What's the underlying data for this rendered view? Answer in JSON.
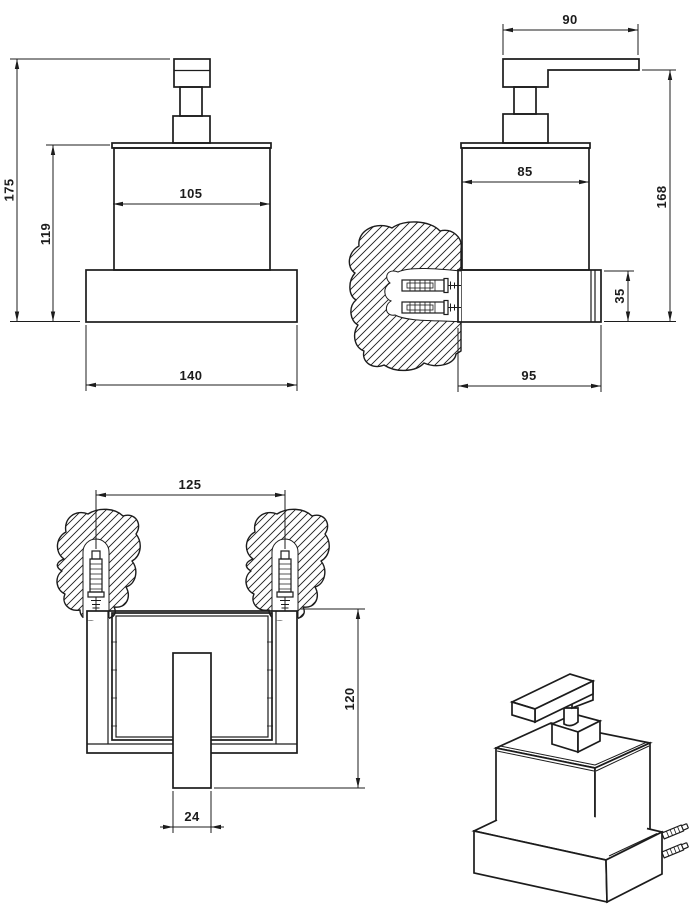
{
  "drawing": {
    "front_view": {
      "overall_height": "175",
      "body_height": "119",
      "body_width": "105",
      "base_width": "140"
    },
    "side_view": {
      "lever_length": "90",
      "body_depth": "85",
      "overall_height": "168",
      "holder_height": "35",
      "holder_depth": "95"
    },
    "top_view": {
      "fixing_spacing": "125",
      "overall_depth": "120",
      "spout_width": "24"
    }
  },
  "colors": {
    "line": "#1c1c1c",
    "background": "#ffffff"
  }
}
